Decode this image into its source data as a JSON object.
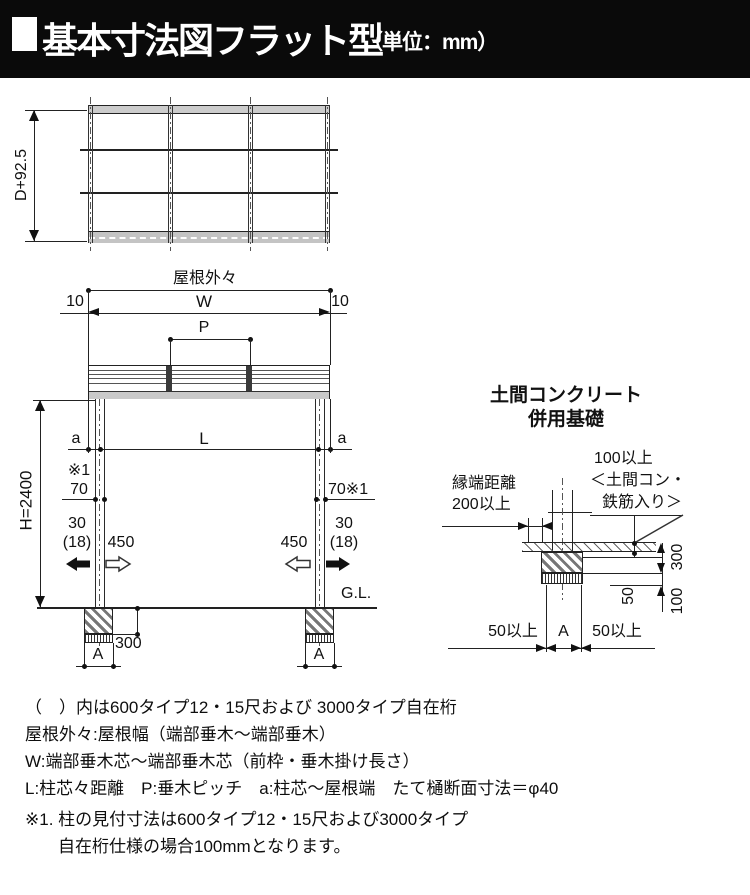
{
  "header": {
    "title": "基本寸法図フラット型",
    "unit": "（単位：mm）"
  },
  "plan_view": {
    "depth_dim": "D+92.5"
  },
  "elevation": {
    "roof_outer_label": "屋根外々",
    "offset_left": "10",
    "width_label": "W",
    "offset_right": "10",
    "pitch_label": "P",
    "a_left": "a",
    "span_label": "L",
    "a_right": "a",
    "note_ref": "※1",
    "col_width_left": "70",
    "col_width_right": "70※1",
    "out_left": "30",
    "out_left_alt": "(18)",
    "in_left": "450",
    "in_right": "450",
    "out_right": "30",
    "out_right_alt": "(18)",
    "height_dim": "H=2400",
    "ground_label": "G.L.",
    "footing_depth": "300",
    "footing_width_left": "A",
    "footing_width_right": "A"
  },
  "foundation_detail": {
    "title_line1": "土間コンクリート",
    "title_line2": "併用基礎",
    "slab_note1": "100以上",
    "slab_note2": "＜土間コン・",
    "slab_note3": "鉄筋入り＞",
    "edge_note1": "縁端距離",
    "edge_note2": "200以上",
    "depth_dim": "300",
    "slab_dim": "100",
    "gravel_dim": "50",
    "margin_left": "50以上",
    "width_label": "A",
    "margin_right": "50以上"
  },
  "notes": {
    "lines": [
      "（　）内は600タイプ12・15尺および 3000タイプ自在桁",
      "屋根外々:屋根幅（端部垂木〜端部垂木）",
      "W:端部垂木芯〜端部垂木芯（前枠・垂木掛け長さ）",
      "L:柱芯々距離　P:垂木ピッチ　a:柱芯〜屋根端　たて樋断面寸法＝φ40",
      "※1. 柱の見付寸法は600タイプ12・15尺および3000タイプ",
      "自在桁仕様の場合100mmとなります。"
    ]
  }
}
